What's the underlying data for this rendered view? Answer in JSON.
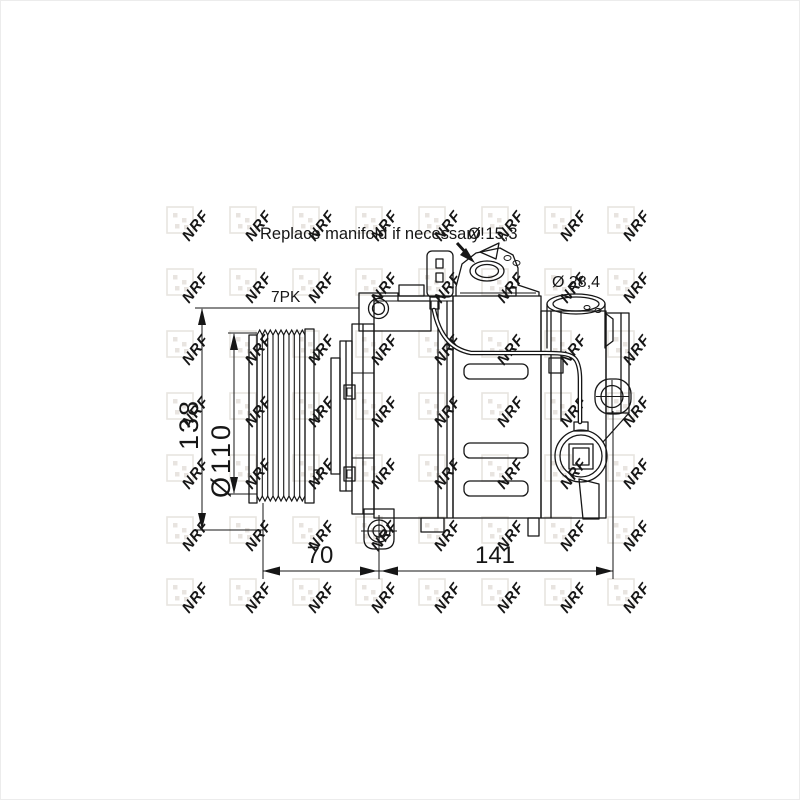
{
  "figure": {
    "note": "Replace manifold if necessary!",
    "labels": {
      "port_small_dia": "Ø 15,3",
      "port_large_dia": "Ø 28,4",
      "belt_type": "7PK",
      "overall_height": "138",
      "pulley_diameter": "Ø110",
      "length_front": "70",
      "length_rear": "141"
    }
  },
  "watermark": {
    "text": "NRF",
    "tile_color": "#e8e4e0",
    "text_color": "#e4dfda",
    "x0": 166,
    "y0": 206,
    "dx": 63,
    "dy": 62,
    "cols": 8,
    "rows": 7,
    "square": 26,
    "rotation": -52,
    "font_size": 15
  },
  "colors": {
    "background": "#ffffff",
    "line": "#161616"
  }
}
